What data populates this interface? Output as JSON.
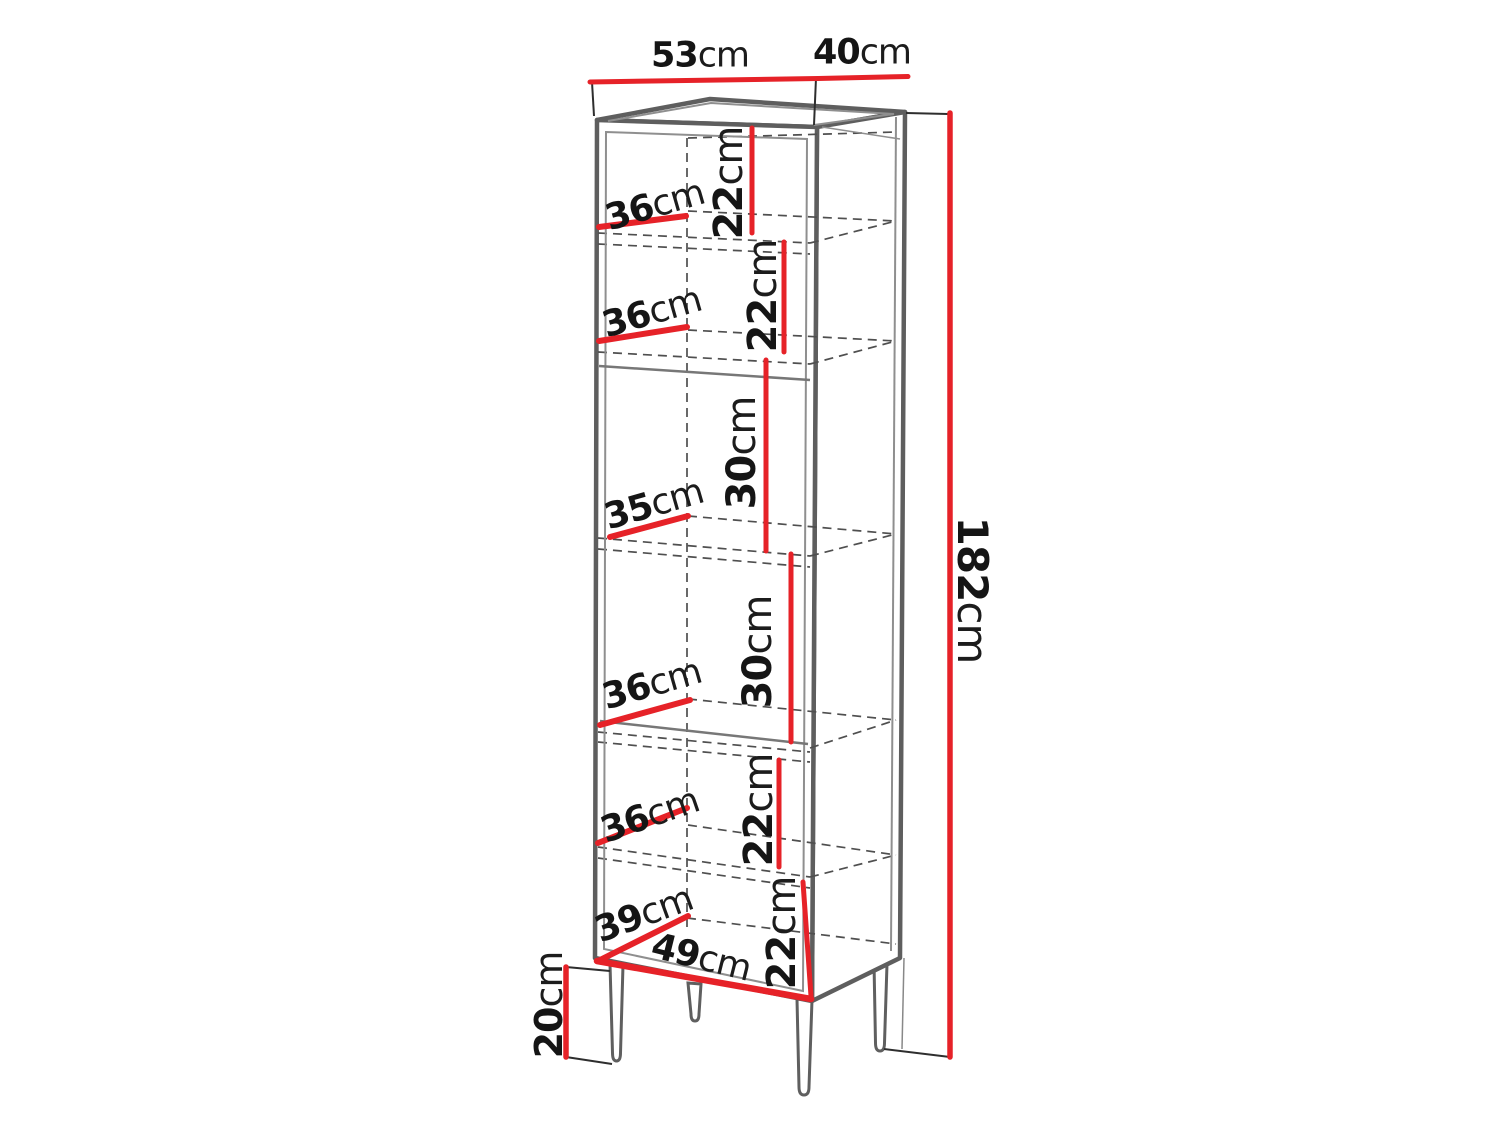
{
  "figure": {
    "kind": "furniture-dimension-diagram",
    "subject": "tall open shelf cabinet on four legs",
    "background": "#ffffff"
  },
  "colors": {
    "dimension_red": "#e62228",
    "outline_gray": "#5e5e5e",
    "hidden_line_gray": "#4f4f4f",
    "text": "#151515"
  },
  "labels": {
    "top_width": {
      "value": "53",
      "unit": "cm"
    },
    "top_depth": {
      "value": "40",
      "unit": "cm"
    },
    "total_height": {
      "value": "182",
      "unit": "cm"
    },
    "leg_height": {
      "value": "20",
      "unit": "cm"
    },
    "c1_width": {
      "value": "36",
      "unit": "cm"
    },
    "c1_height": {
      "value": "22",
      "unit": "cm"
    },
    "c2_width": {
      "value": "36",
      "unit": "cm"
    },
    "c2_height": {
      "value": "22",
      "unit": "cm"
    },
    "c3_width": {
      "value": "35",
      "unit": "cm"
    },
    "c3_height": {
      "value": "30",
      "unit": "cm"
    },
    "c4_width": {
      "value": "36",
      "unit": "cm"
    },
    "c4_height": {
      "value": "30",
      "unit": "cm"
    },
    "c5_width": {
      "value": "36",
      "unit": "cm"
    },
    "c5_height": {
      "value": "22",
      "unit": "cm"
    },
    "c6_depth": {
      "value": "39",
      "unit": "cm"
    },
    "c6_width": {
      "value": "49",
      "unit": "cm"
    },
    "c6_height": {
      "value": "22",
      "unit": "cm"
    }
  }
}
